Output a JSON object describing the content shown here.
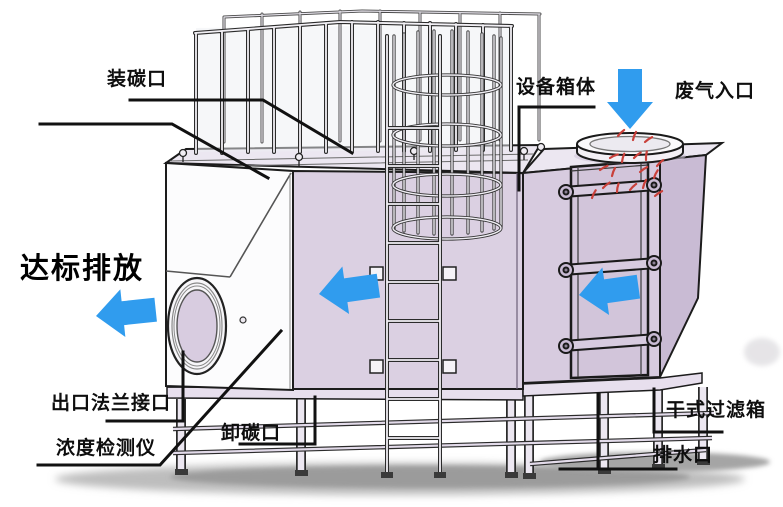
{
  "diagram": {
    "type": "activated-carbon-adsorption-equipment-illustration",
    "labels": {
      "carbon_loading_port": "装碳口",
      "equipment_box_body": "设备箱体",
      "waste_gas_inlet": "废气入口",
      "compliant_discharge": "达标排放",
      "outlet_flange_port": "出口法兰接口",
      "concentration_detector": "浓度检测仪",
      "carbon_unloading_port": "卸碳口",
      "dry_filter_box": "干式过滤箱",
      "drain_outlet": "排水口"
    },
    "colors": {
      "flow_arrow": "#309CEE",
      "box_front": "#DBD0E2",
      "box_front_right": "#D7CBDF",
      "box_side": "#C9BBD4",
      "box_top": "#ECE7F1",
      "door_panel": "#D2C5DA",
      "base_strip": "#E7DFED",
      "white_face": "#FCFCFD",
      "outline": "#1C1C1C",
      "particles": "#C9403A",
      "shadow": "#A8A8A8"
    }
  }
}
